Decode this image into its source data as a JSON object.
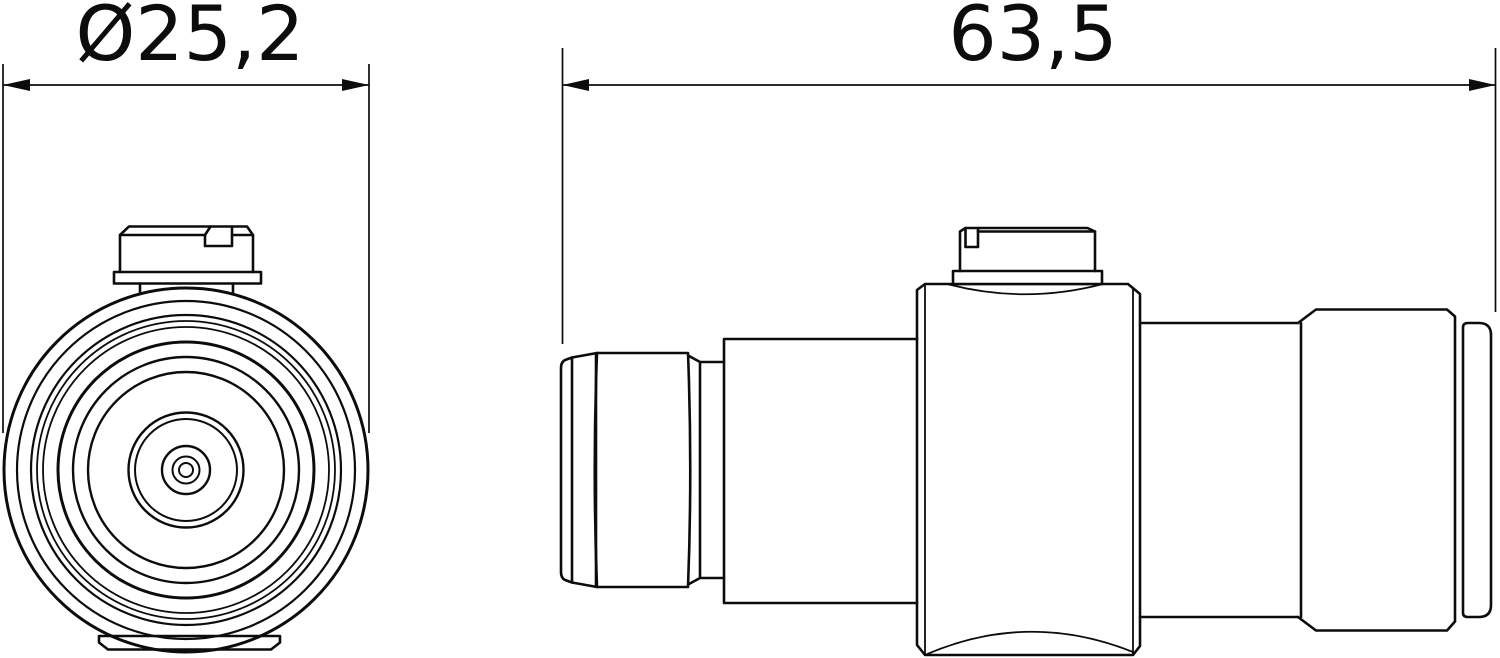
{
  "page": {
    "background_color": "#ffffff",
    "line_color": "#0c0c0c",
    "drawing_type": "technical-drawing"
  },
  "drawing": {
    "front_view": {
      "dimension_label": "Ø25,2",
      "dimension_value": 25.2
    },
    "side_view": {
      "dimension_label": "63,5",
      "dimension_value": 63.5
    }
  }
}
